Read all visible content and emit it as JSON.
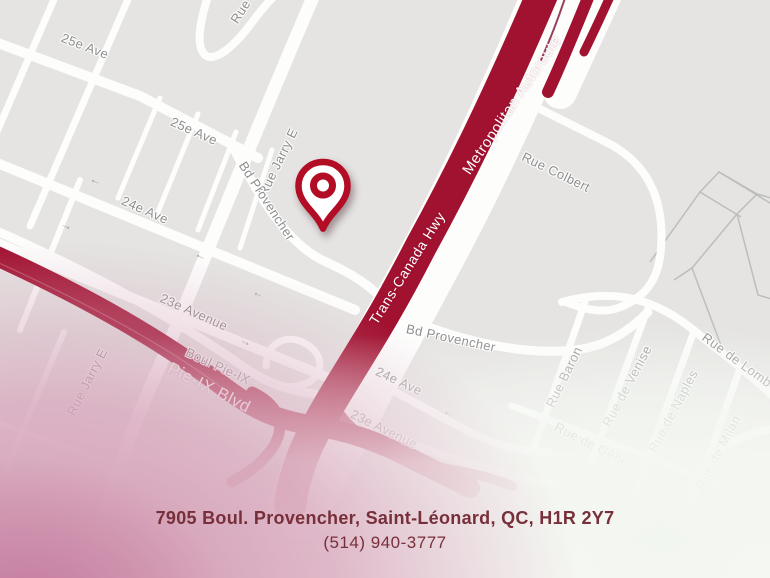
{
  "map": {
    "street_labels": [
      {
        "text": "25e Ave"
      },
      {
        "text": "Rue B"
      },
      {
        "text": "Rue Jarry E"
      },
      {
        "text": "25e Ave"
      },
      {
        "text": "Bd Provencher"
      },
      {
        "text": "24e Ave"
      },
      {
        "text": "23e Avenue"
      },
      {
        "text": "Boul Pie-IX"
      },
      {
        "text": "Rue Jarry E"
      },
      {
        "text": "21e Av"
      },
      {
        "text": "Rue Colbert"
      },
      {
        "text": "Bd Provencher"
      },
      {
        "text": "24e Ave"
      },
      {
        "text": "23e Avenue"
      },
      {
        "text": "Rue Baron"
      },
      {
        "text": "Rue de Venise"
      },
      {
        "text": "Rue de Naples"
      },
      {
        "text": "Rue de Gênes"
      },
      {
        "text": "Rue de Milan"
      },
      {
        "text": "Rue de Lomb"
      }
    ],
    "highway_labels": [
      {
        "text": "Metropolitan Autoroute"
      },
      {
        "text": "Trans-Canada Hwy"
      },
      {
        "text": "Pie-IX Blvd"
      }
    ],
    "icons": {
      "one_way_left": "←",
      "one_way_right": "→"
    },
    "colors": {
      "highway_red": "#a11130",
      "pin_red": "#b30d26",
      "map_background": "#e5e4e2",
      "road_white": "#fdfdfc",
      "label_gray": "#8e8e8e",
      "pink_fade": "#c983a3",
      "footer_text": "#772f3a"
    }
  },
  "footer": {
    "address": "7905 Boul. Provencher, Saint-Léonard, QC, H1R 2Y7",
    "phone": "(514) 940-3777"
  }
}
